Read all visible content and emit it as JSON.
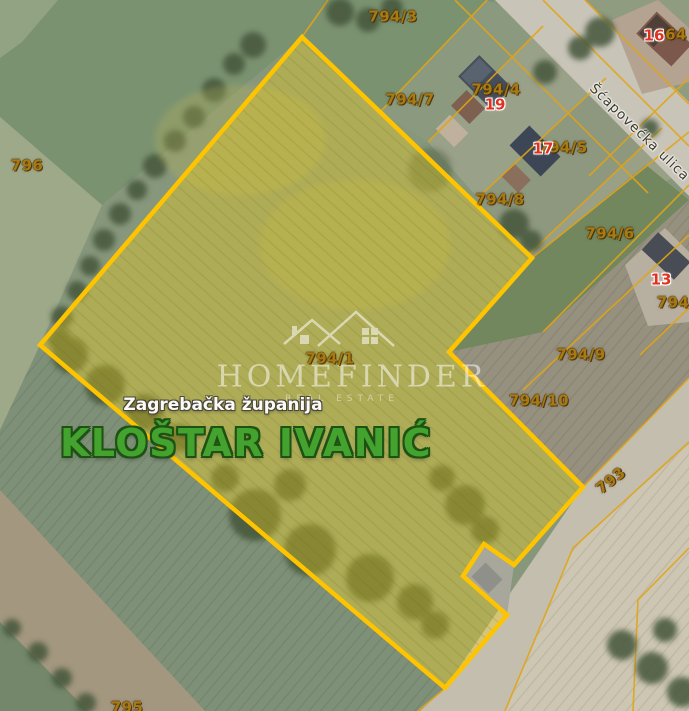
{
  "map": {
    "watermark": {
      "brand": "HOMEFINDER",
      "tagline": "REAL ESTATE"
    },
    "region_label": "Zagrebačka županija",
    "municipality_label": "KLOŠTAR IVANIĆ",
    "highlighted_parcel_id": "794/1",
    "street_name": "Šćapovećka ulica",
    "colors": {
      "parcel_boundary": "#FFC400",
      "parcel_highlight_fill": "rgba(247,211,20,0.35)",
      "cadastral_line": "#E2A414",
      "parcel_label": "#AA7A12",
      "house_number": "#E03222",
      "municipality_green": "#44A32E"
    },
    "labels": [
      {
        "text": "794/3",
        "x": 393,
        "y": 17,
        "cls": "parcel-number"
      },
      {
        "text": "794/7",
        "x": 410,
        "y": 100,
        "cls": "parcel-number"
      },
      {
        "text": "794/4",
        "x": 496,
        "y": 90,
        "cls": "parcel-number"
      },
      {
        "text": "19",
        "x": 495,
        "y": 105,
        "cls": "house-number"
      },
      {
        "text": "794/5",
        "x": 563,
        "y": 148,
        "cls": "parcel-number"
      },
      {
        "text": "17",
        "x": 543,
        "y": 149,
        "cls": "house-number"
      },
      {
        "text": "16",
        "x": 654,
        "y": 36,
        "cls": "house-number"
      },
      {
        "text": "64",
        "x": 676,
        "y": 35,
        "cls": "parcel-number"
      },
      {
        "text": "794/8",
        "x": 500,
        "y": 200,
        "cls": "parcel-number"
      },
      {
        "text": "794/6",
        "x": 610,
        "y": 234,
        "cls": "parcel-number"
      },
      {
        "text": "13",
        "x": 661,
        "y": 280,
        "cls": "house-number"
      },
      {
        "text": "794/",
        "x": 676,
        "y": 303,
        "cls": "parcel-number"
      },
      {
        "text": "794/9",
        "x": 581,
        "y": 355,
        "cls": "parcel-number"
      },
      {
        "text": "794/10",
        "x": 539,
        "y": 401,
        "cls": "parcel-number"
      },
      {
        "text": "794/1",
        "x": 330,
        "y": 359,
        "cls": "parcel-number"
      },
      {
        "text": "793",
        "x": 611,
        "y": 481,
        "rot": -38,
        "cls": "parcel-number"
      },
      {
        "text": "796",
        "x": 27,
        "y": 166,
        "cls": "parcel-number"
      },
      {
        "text": "795",
        "x": 127,
        "y": 708,
        "cls": "parcel-number"
      },
      {
        "text": "Šćapovećka ulica",
        "x": 639,
        "y": 133,
        "rot": 44,
        "cls": "street-name"
      }
    ]
  }
}
